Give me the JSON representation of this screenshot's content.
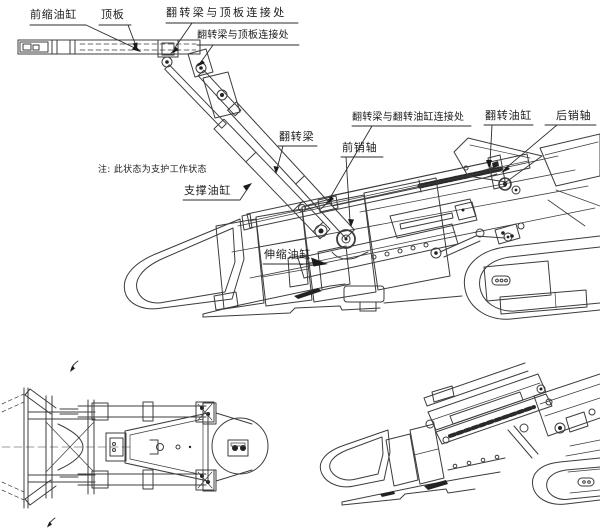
{
  "app": {
    "type": "cad-engineering-drawing",
    "background": "#ffffff",
    "line_color": "#3c3c3c",
    "text_color": "#1b1b1b",
    "arrow_color": "#1a1a1a"
  },
  "labels": {
    "front_retract_cylinder": "前缩油缸",
    "top_plate": "顶板",
    "flip_beam_top_joint_1": "翻转梁与顶板连接处",
    "flip_beam_top_joint_2": "翻转梁与顶板连接处",
    "flip_beam_cylinder_joint": "翻转梁与翻转油缸连接处",
    "flip_cylinder": "翻转油缸",
    "rear_pin": "后销轴",
    "flip_beam": "翻转梁",
    "front_pin": "前销轴",
    "support_cylinder": "支撑油缸",
    "telescopic_cylinder": "伸缩油缸",
    "note": "注: 此状态为支护工作状态"
  }
}
